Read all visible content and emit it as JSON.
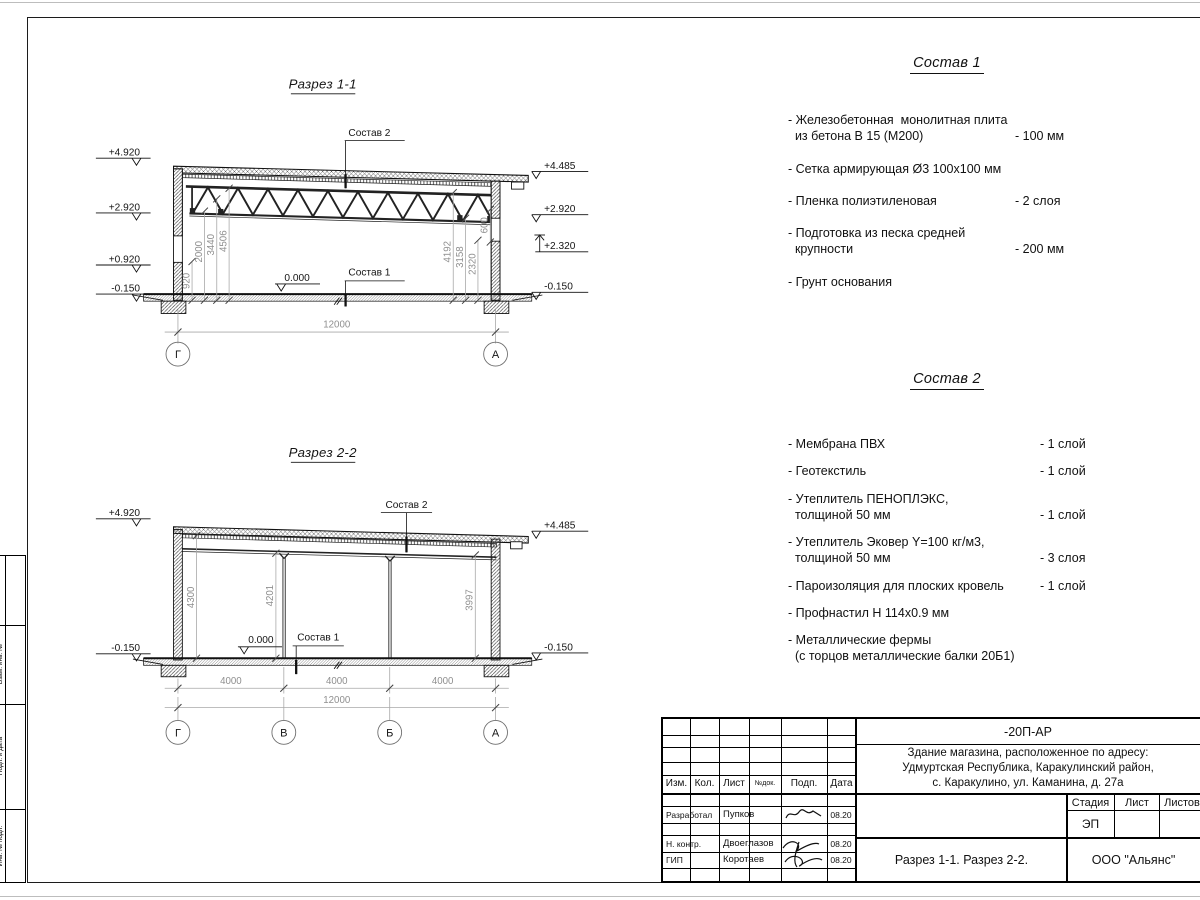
{
  "section1": {
    "title": "Разрез 1-1",
    "labels": {
      "sostav2": "Состав 2",
      "sostav1": "Состав 1",
      "zero": "0.000"
    },
    "elev_left": [
      "+4.920",
      "+2.920",
      "+0.920",
      "-0.150"
    ],
    "elev_right": [
      "+4.485",
      "+2.920",
      "+2.320",
      "-0.150"
    ],
    "dims_left": [
      "920",
      "2000",
      "3440",
      "4506"
    ],
    "dims_right": [
      "4192",
      "3158",
      "2320",
      "600"
    ],
    "dim_total": "12000",
    "axes": [
      "Г",
      "А"
    ]
  },
  "section2": {
    "title": "Разрез 2-2",
    "labels": {
      "sostav2": "Состав 2",
      "sostav1": "Состав 1",
      "zero": "0.000"
    },
    "elev_left": [
      "+4.920",
      "-0.150"
    ],
    "elev_right": [
      "+4.485",
      "-0.150"
    ],
    "dims_inner": [
      "4300",
      "4201",
      "3997"
    ],
    "dims_bottom": [
      "4000",
      "4000",
      "4000"
    ],
    "dim_total": "12000",
    "axes": [
      "Г",
      "В",
      "Б",
      "А"
    ]
  },
  "sostav1": {
    "title": "Состав 1",
    "items": [
      {
        "name": "- Железобетонная  монолитная плита\n  из бетона В 15 (М200)",
        "value": "- 100 мм"
      },
      {
        "name": "- Сетка армирующая Ø3 100х100 мм",
        "value": ""
      },
      {
        "name": "- Пленка полиэтиленовая",
        "value": "-  2 слоя"
      },
      {
        "name": "- Подготовка из песка средней\n  крупности",
        "value": "- 200 мм"
      },
      {
        "name": "- Грунт основания",
        "value": ""
      }
    ]
  },
  "sostav2": {
    "title": "Состав 2",
    "items": [
      {
        "name": "- Мембрана ПВХ",
        "value": "- 1 слой"
      },
      {
        "name": "- Геотекстиль",
        "value": "- 1 слой"
      },
      {
        "name": "- Утеплитель ПЕНОПЛЭКС,\n  толщиной 50 мм",
        "value": "- 1 слой"
      },
      {
        "name": "- Утеплитель Эковер Y=100 кг/м3,\n  толщиной 50 мм",
        "value": "- 3 слоя"
      },
      {
        "name": "- Пароизоляция для плоских кровель",
        "value": "- 1 слой"
      },
      {
        "name": "- Профнастил Н 114х0.9 мм",
        "value": ""
      },
      {
        "name": "- Металлические фермы\n  (с торцов металлические балки 20Б1)",
        "value": ""
      }
    ]
  },
  "titleblock": {
    "code": "-20П-АР",
    "object_lines": [
      "Здание магазина, расположенное по адресу:",
      "Удмуртская Республика, Каракулинский район,",
      "с. Каракулино, ул. Каманина, д. 27а"
    ],
    "columns": [
      "Изм.",
      "Кол.",
      "Лист",
      "№док.",
      "Подп.",
      "Дата"
    ],
    "sign_rows": [
      {
        "role": "Разработал",
        "name": "Пупков",
        "date": "08.20"
      },
      {
        "role": "Н. контр.",
        "name": "Двоеглазов",
        "date": "08.20"
      },
      {
        "role": "ГИП",
        "name": "Коротаев",
        "date": "08.20"
      }
    ],
    "stage_label": "Стадия",
    "list_label": "Лист",
    "listov_label": "Листов",
    "stage_value": "ЭП",
    "drawing_title": "Разрез 1-1. Разрез 2-2.",
    "company": "ООО \"Альянс\""
  },
  "side_stamp": {
    "labels": [
      "Взам. инв. №",
      "Подп. и дата",
      "Инв. № подл."
    ]
  }
}
